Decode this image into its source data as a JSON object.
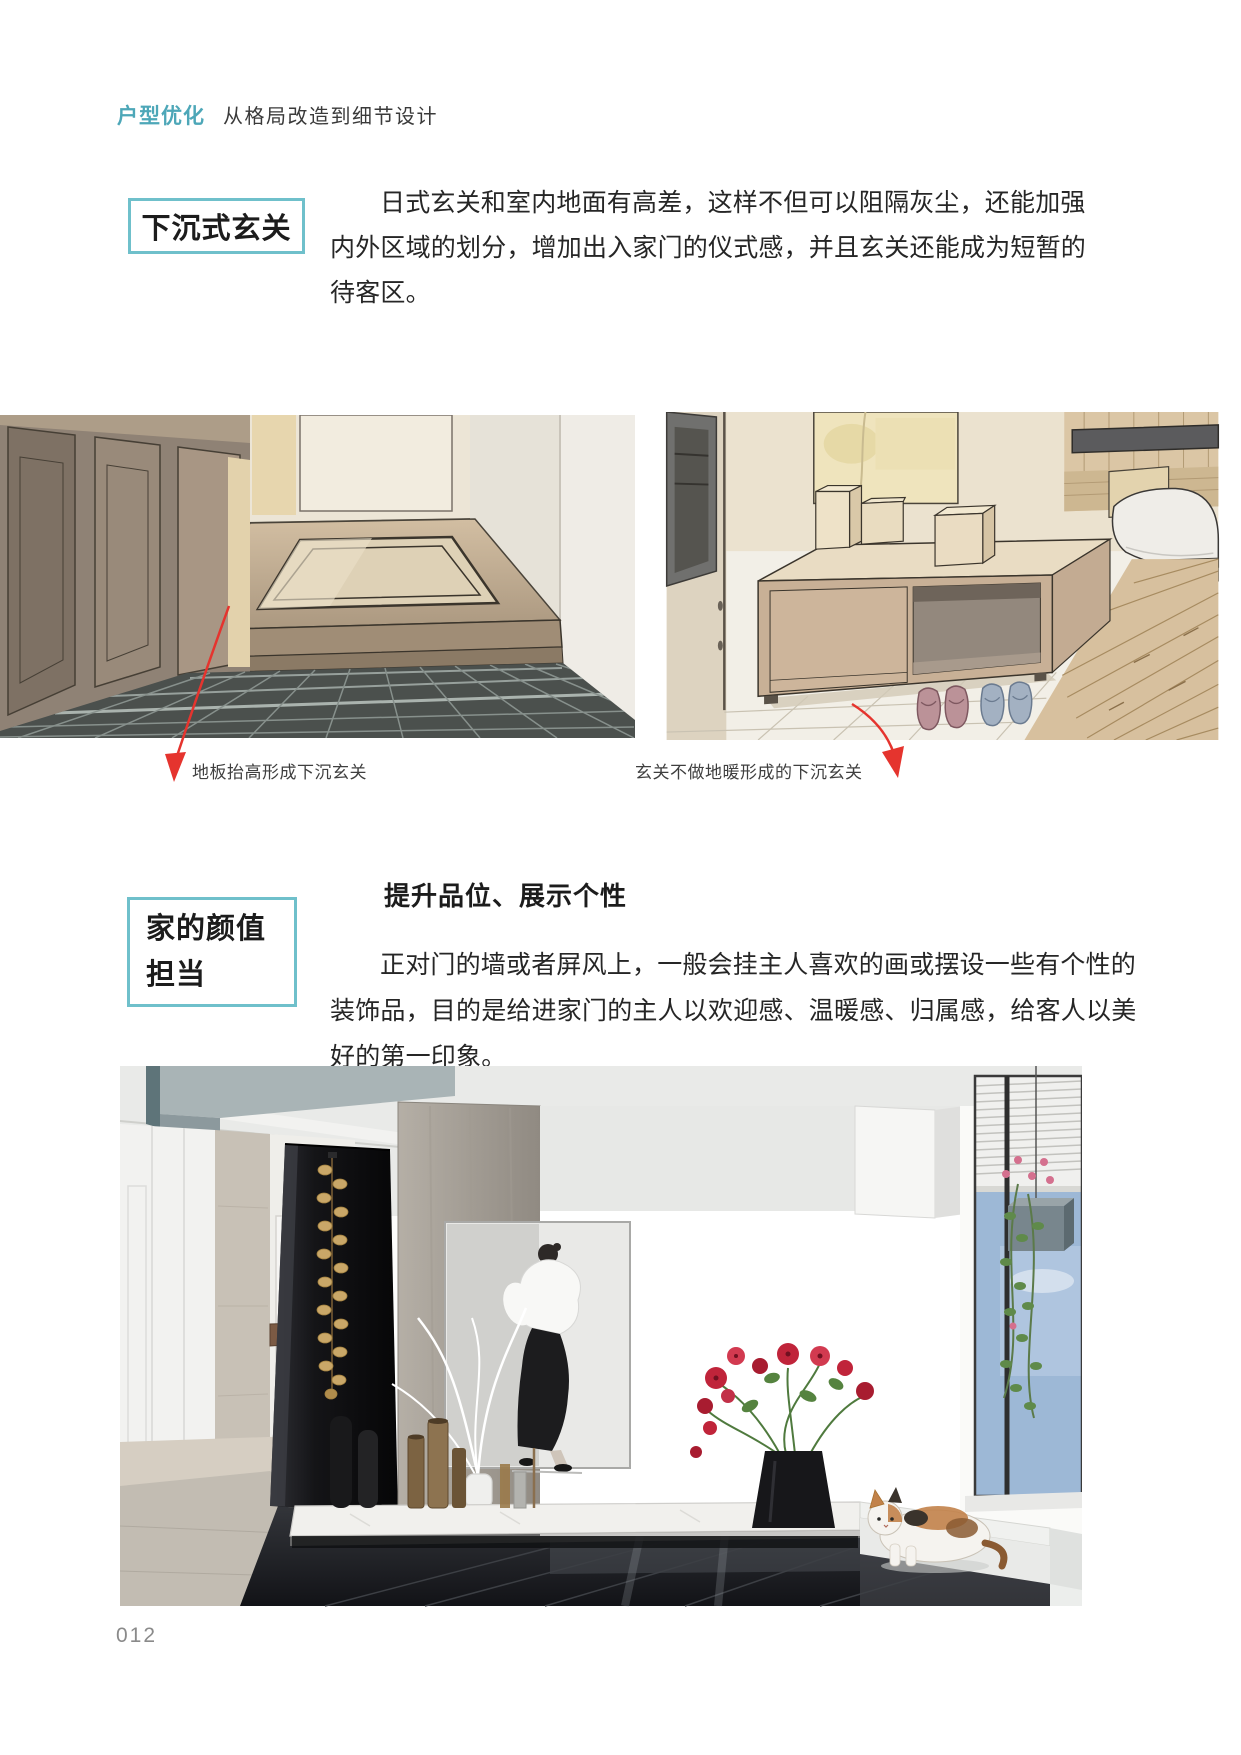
{
  "palette": {
    "accent": "#6fc0cb",
    "accent_text": "#4da7b8",
    "arrow_red": "#e5342e",
    "body_text": "#262626",
    "caption_text": "#3f3f3f",
    "page_number_color": "#8a8a8a"
  },
  "header": {
    "highlight": "户型优化",
    "subtitle": "从格局改造到细节设计"
  },
  "sections": [
    {
      "title": "下沉式玄关",
      "para_lines": [
        "日式玄关和室内地面有高差，这样不但可以阻隔灰尘，还能加强",
        "内外区域的划分，增加出入家门的仪式感，并且玄关还能成为短暂的",
        "待客区。"
      ],
      "figures": [
        {
          "caption": "地板抬高形成下沉玄关"
        },
        {
          "caption": "玄关不做地暖形成的下沉玄关"
        }
      ]
    },
    {
      "title_lines": [
        "家的颜值",
        "担当"
      ],
      "heading": "提升品位、展示个性",
      "para_lines": [
        "正对门的墙或者屏风上，一般会挂主人喜欢的画或摆设一些有个性的",
        "装饰品，目的是给进家门的主人以欢迎感、温暖感、归属感，给客人以美",
        "好的第一印象。"
      ]
    }
  ],
  "page_number": "012"
}
